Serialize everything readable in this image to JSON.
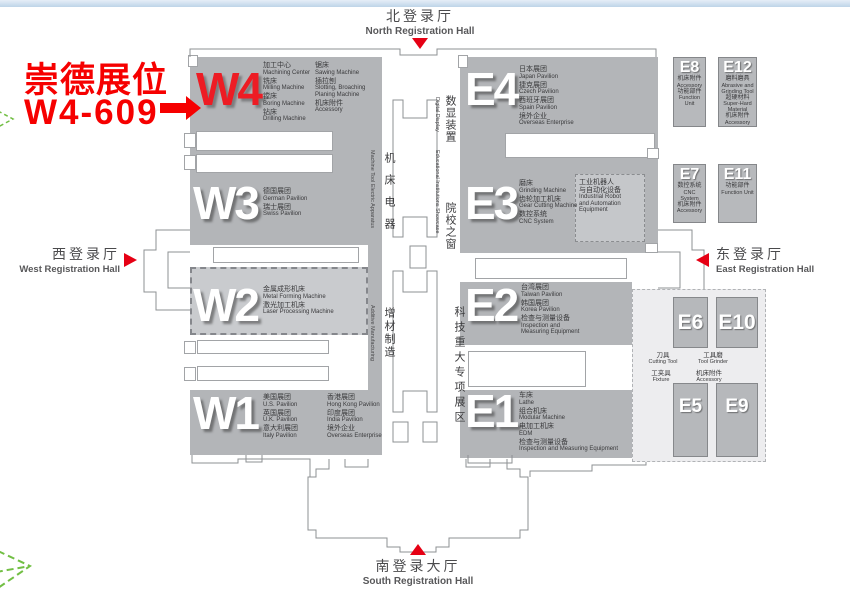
{
  "colors": {
    "hall_gray": "#b3b5b8",
    "light_hall_gray": "#c9cbce",
    "accent_red": "#ed1c24",
    "leaf_green": "#72bf44",
    "top_bar_blue": "#cfe0ef"
  },
  "annotation": {
    "line1": "崇德展位",
    "line2": "W4-609"
  },
  "registration": {
    "north": {
      "zh": "北登录厅",
      "en": "North Registration Hall"
    },
    "south": {
      "zh": "南登录大厅",
      "en": "South Registration Hall"
    },
    "west": {
      "zh": "西登录厅",
      "en": "West Registration Hall"
    },
    "east": {
      "zh": "东登录厅",
      "en": "East Registration Hall"
    }
  },
  "zones": {
    "machine_tool_electric": {
      "zh": "机床电器",
      "en": "Machine Tool Electric Apparatus"
    },
    "digital_display": {
      "zh": "数显装置",
      "en": "Digital Display"
    },
    "educational": {
      "zh": "院校之窗",
      "en": "Educational Institutions Showcase"
    },
    "additive": {
      "zh": "增材制造",
      "en": "Additive Manufacturing"
    },
    "science_major": {
      "zh": "科技重大专项展区"
    }
  },
  "halls": {
    "w4": {
      "id": "W4",
      "items_col1": [
        {
          "zh": "加工中心",
          "en": "Machining Center"
        },
        {
          "zh": "铣床",
          "en": "Milling Machine"
        },
        {
          "zh": "镗床",
          "en": "Boring Machine"
        },
        {
          "zh": "钻床",
          "en": "Drilling Machine"
        }
      ],
      "items_col2": [
        {
          "zh": "锯床",
          "en": "Sawing Machine"
        },
        {
          "zh": "插拉刨",
          "en": "Slotting, Broaching\nPlaning Machine"
        },
        {
          "zh": "机床附件",
          "en": "Accessory"
        }
      ]
    },
    "w3": {
      "id": "W3",
      "items": [
        {
          "zh": "德国展团",
          "en": "German Pavilion"
        },
        {
          "zh": "瑞士展团",
          "en": "Swiss Pavilion"
        }
      ]
    },
    "w2": {
      "id": "W2",
      "items": [
        {
          "zh": "金属成形机床",
          "en": "Metal Forming Machine"
        },
        {
          "zh": "激光加工机床",
          "en": "Laser Processing Machine"
        }
      ]
    },
    "w1": {
      "id": "W1",
      "items_col1": [
        {
          "zh": "美国展团",
          "en": "U.S. Pavilion"
        },
        {
          "zh": "英国展团",
          "en": "U.K. Pavilion"
        },
        {
          "zh": "意大利展团",
          "en": "Italy Pavilion"
        }
      ],
      "items_col2": [
        {
          "zh": "香港展团",
          "en": "Hong Kong Pavilion"
        },
        {
          "zh": "印度展团",
          "en": "India Pavilion"
        },
        {
          "zh": "境外企业",
          "en": "Overseas Enterprise"
        }
      ]
    },
    "e4": {
      "id": "E4",
      "items": [
        {
          "zh": "日本展团",
          "en": "Japan Pavilion"
        },
        {
          "zh": "捷克展团",
          "en": "Czech Pavilion"
        },
        {
          "zh": "西班牙展团",
          "en": "Spain Pavilion"
        },
        {
          "zh": "境外企业",
          "en": "Overseas Enterprise"
        }
      ]
    },
    "e3": {
      "id": "E3",
      "items": [
        {
          "zh": "磨床",
          "en": "Grinding Machine"
        },
        {
          "zh": "齿轮加工机床",
          "en": "Gear Cutting Machine"
        },
        {
          "zh": "数控系统",
          "en": "CNC System"
        }
      ],
      "robot_box": {
        "zh": "工业机器人\n与自动化设备",
        "en": "Industrial Robot\nand Automation\nEquipment"
      }
    },
    "e2": {
      "id": "E2",
      "items": [
        {
          "zh": "台湾展团",
          "en": "Taiwan Pavilion"
        },
        {
          "zh": "韩国展团",
          "en": "Korea Pavilion"
        },
        {
          "zh": "检查与测量设备",
          "en": "Inspection and\nMeasuring Equipment"
        }
      ]
    },
    "e1": {
      "id": "E1",
      "items": [
        {
          "zh": "车床",
          "en": "Lathe"
        },
        {
          "zh": "组合机床",
          "en": "Modular Machine"
        },
        {
          "zh": "电加工机床",
          "en": "EDM"
        },
        {
          "zh": "检查与测量设备",
          "en": "Inspection and Measuring Equipment"
        }
      ]
    }
  },
  "small_halls": [
    {
      "id": "E8",
      "items": [
        {
          "zh": "机床附件",
          "en": "Accessory"
        },
        {
          "zh": "功能部件",
          "en": "Function Unit"
        }
      ]
    },
    {
      "id": "E12",
      "items": [
        {
          "zh": "磨料磨具",
          "en": "Abrasive and\nGrinding Tool"
        },
        {
          "zh": "超硬材料",
          "en": "Super-Hard\nMaterial"
        },
        {
          "zh": "机床附件",
          "en": "Accessory"
        }
      ]
    },
    {
      "id": "E7",
      "items": [
        {
          "zh": "数控系统",
          "en": "CNC System"
        },
        {
          "zh": "机床附件",
          "en": "Accessory"
        }
      ]
    },
    {
      "id": "E11",
      "items": [
        {
          "zh": "功能部件",
          "en": "Function Unit"
        }
      ]
    }
  ],
  "east_boxes": {
    "e6": "E6",
    "e10": "E10",
    "e5": "E5",
    "e9": "E9",
    "labels": [
      {
        "zh": "刀具",
        "en": "Cutting Tool"
      },
      {
        "zh": "工具磨",
        "en": "Tool Grinder"
      },
      {
        "zh": "工夹具",
        "en": "Fixture"
      },
      {
        "zh": "机床附件",
        "en": "Accessory"
      }
    ]
  }
}
